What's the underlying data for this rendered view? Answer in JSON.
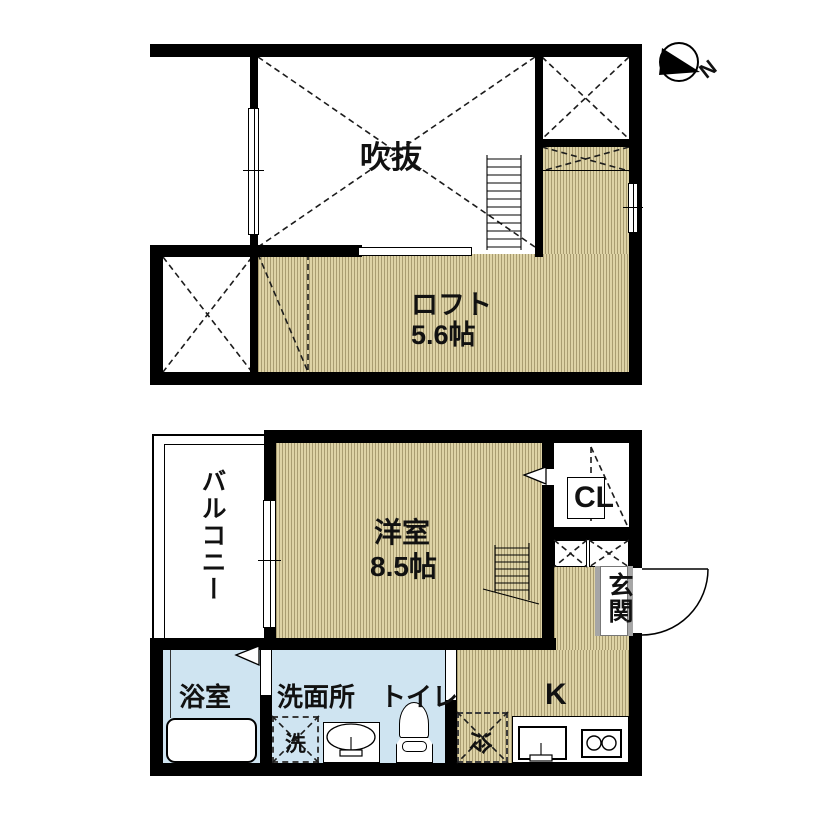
{
  "compass": {
    "north_label": "N"
  },
  "upper_floor": {
    "void_label": "吹抜",
    "loft_label": "ロフト",
    "loft_size": "5.6帖"
  },
  "lower_floor": {
    "western_room_label": "洋室",
    "western_room_size": "8.5帖",
    "balcony_label": "バルコニー",
    "closet_label": "CL",
    "entrance_label": "玄関",
    "kitchen_label": "K",
    "bathroom_label": "浴室",
    "washroom_label": "洗面所",
    "toilet_label": "トイレ",
    "washer_label": "洗",
    "refrigerator_label": "冷"
  },
  "colors": {
    "wall": "#000000",
    "wood_floor": "#ded3a6",
    "wood_floor_stripe": "#a89c6f",
    "wet_area_floor": "#cfe4f1",
    "background": "#ffffff"
  }
}
